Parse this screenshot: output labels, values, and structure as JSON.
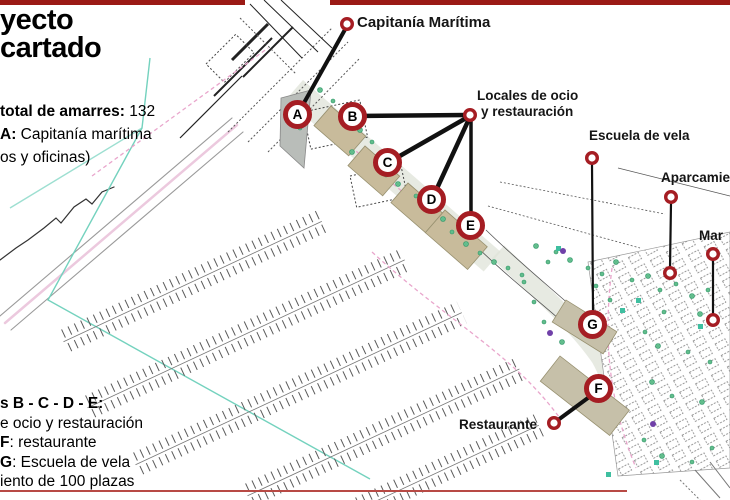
{
  "title": {
    "line1": "yecto",
    "line2": "cartado"
  },
  "notes_top": {
    "amarres_label": "total de amarres:",
    "amarres_value": " 132",
    "a_label": "A:",
    "a_text": " Capitanía marítima",
    "a_cont": "os y oficinas)"
  },
  "notes_bottom": {
    "line1": "s B - C - D - E:",
    "line2": "e ocio y restauración",
    "f_label": "F",
    "f_text": ": restaurante",
    "g_label": "G",
    "g_text": ": Escuela de vela",
    "line5": "iento de 100 plazas"
  },
  "map_labels": {
    "capitania": "Capitanía Marítima",
    "locales_1": "Locales de ocio",
    "locales_2": "y restauración",
    "escuela": "Escuela de vela",
    "aparcamiento": "Aparcamiento",
    "mar": "Mar",
    "restaurante": "Restaurante"
  },
  "markers": {
    "letters": [
      "A",
      "B",
      "C",
      "D",
      "E",
      "F",
      "G"
    ]
  },
  "colors": {
    "top_bar_red": "#9b1a15",
    "marker_ring_red": "#a51d23",
    "bottom_rule_red": "#b84a45",
    "connector_black": "#111111",
    "vegetation_green": "#62bd8c",
    "teal_boundary": "#74d2be",
    "pink_road": "#e9a6cc",
    "building_tan": "#c8bb9b"
  }
}
